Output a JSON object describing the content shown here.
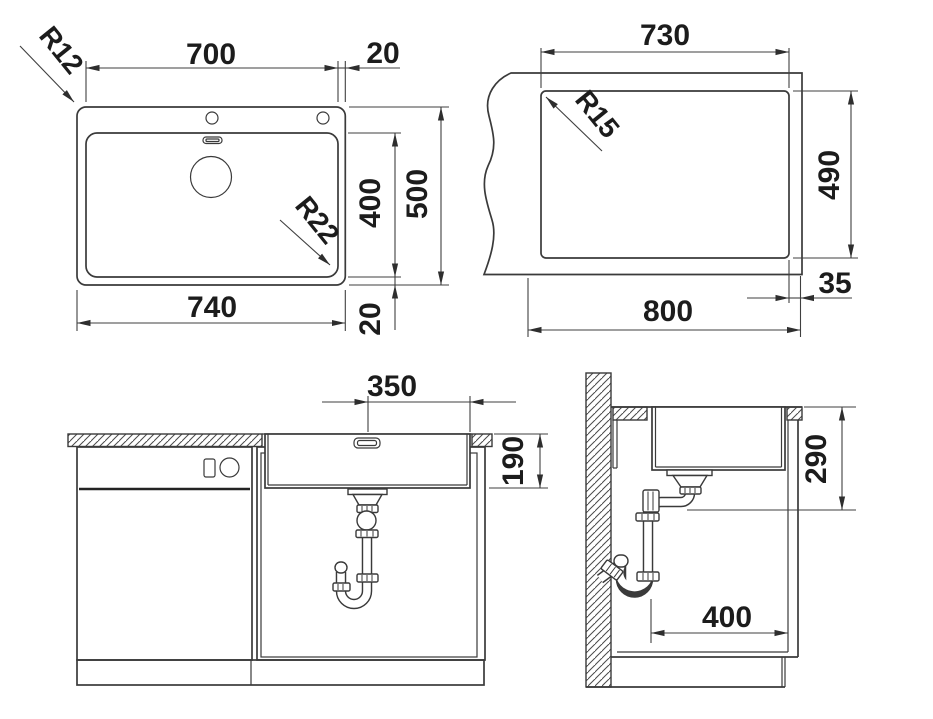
{
  "plan_view": {
    "bowl_width_mm": "700",
    "right_rim_mm": "20",
    "bowl_depth_mm": "400",
    "overall_depth_mm": "500",
    "bottom_rim_mm": "20",
    "overall_width_mm": "740",
    "outer_corner_radius": "R12",
    "bowl_corner_radius": "R22"
  },
  "cutout_view": {
    "cutout_width_mm": "730",
    "cutout_depth_mm": "490",
    "front_edge_distance_mm": "35",
    "cabinet_width_mm": "800",
    "cutout_corner_radius": "R15"
  },
  "front_view": {
    "drain_to_edge_mm": "350",
    "bowl_depth_mm": "190"
  },
  "side_view": {
    "mounting_depth_mm": "290",
    "base_clearance_mm": "400"
  },
  "colors": {
    "background": "#ffffff",
    "line": "#3a3a3a",
    "text": "#1c1c1c"
  }
}
